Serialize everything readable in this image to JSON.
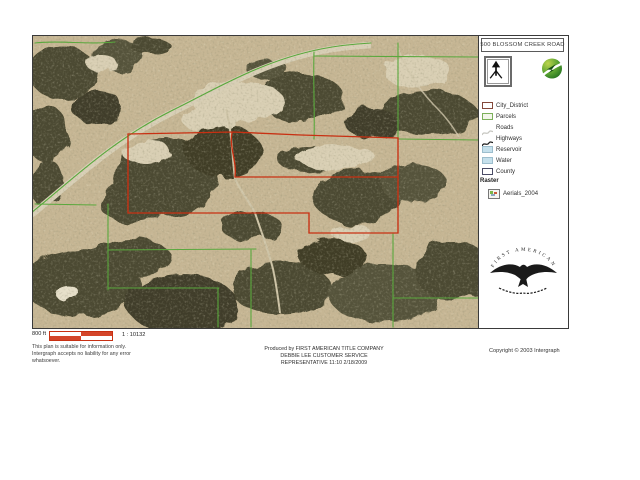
{
  "plat": {
    "title": "500 BLOSSOM CREEK ROAD"
  },
  "legend": {
    "items": [
      {
        "label": "City_District",
        "type": "outline",
        "color": "#84483a",
        "fill": "#ffffff"
      },
      {
        "label": "Parcels",
        "type": "outline",
        "color": "#7cb05a",
        "fill": "#f3f6ea"
      },
      {
        "label": "Roads",
        "type": "line",
        "color": "#c6c6c0"
      },
      {
        "label": "Highways",
        "type": "line",
        "color": "#1c1c1c"
      },
      {
        "label": "Reservoir",
        "type": "fill",
        "color": "#9dbecd",
        "fill": "#c5e0ec"
      },
      {
        "label": "Water",
        "type": "fill",
        "color": "#9dbecd",
        "fill": "#c5e0ec"
      },
      {
        "label": "County",
        "type": "outline",
        "color": "#4a4c66",
        "fill": "#ffffff"
      }
    ],
    "raster_heading": "Raster",
    "raster_item_label": "Aerials_2004"
  },
  "branding": {
    "eagle_arc_text": "FIRST AMERICAN"
  },
  "icons": {
    "north_arrow": "north-arrow-icon",
    "vendor_logo": "geomedia-leaf-icon",
    "raster_item": "raster-thumbnail-icon",
    "eagle": "first-american-eagle-logo"
  },
  "scale": {
    "bar_label": "800 ft",
    "ratio": "1 : 10132"
  },
  "notes": {
    "disclaimer_line1": "This plan is suitable for information only.",
    "disclaimer_line2": "Intergraph accepts no liability for any error",
    "disclaimer_line3": "whatsoever.",
    "produced_line1": "Produced by FIRST AMERICAN TITLE COMPANY",
    "produced_line2": "DEBBIE LEE CUSTOMER SERVICE",
    "produced_line3": "REPRESENTATIVE 11:10 2/18/2009",
    "copyright": "Copyright © 2003 Intergraph"
  },
  "map": {
    "colors": {
      "terrain_base": "#c6b694",
      "terrain_dark": "#4b4830",
      "terrain_light": "#d9cfb4",
      "road_fill": "#d8cfb6",
      "parcel_line_green": "#5aa83d",
      "boundary_red": "#c83012"
    }
  }
}
